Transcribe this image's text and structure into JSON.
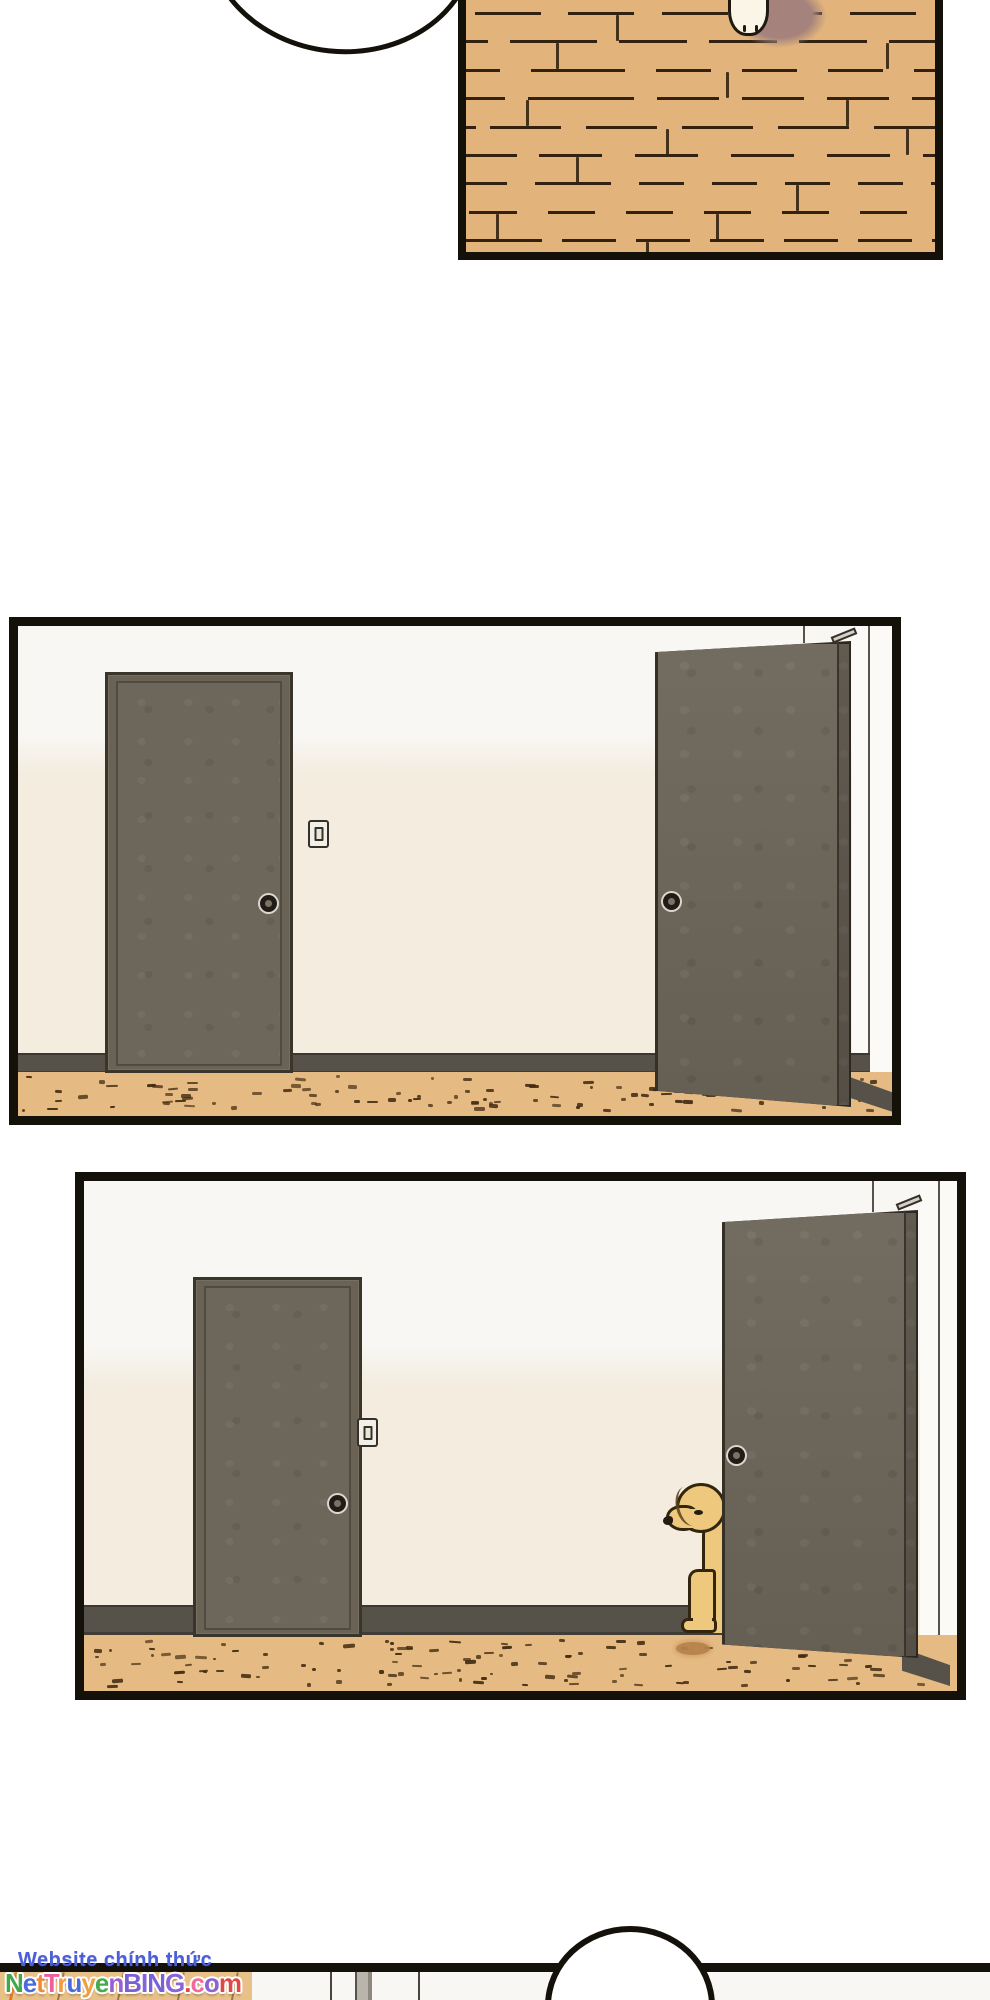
{
  "palette": {
    "ink": "#14110b",
    "wood": "#e2b47c",
    "wood_line": "#33220f",
    "wall_top": "#f8f7f3",
    "wall_low": "#f3ecdf",
    "wall_side": "#fbfaf7",
    "door": "#6d665a",
    "door_outline": "#353026",
    "door_frame": "#6a6355",
    "baseboard": "#56524a",
    "floor": "#e6ba83",
    "speck": "#402a10",
    "dog": "#eec87d",
    "dog_outline": "#33260f",
    "shadow_brown": "#a5837c",
    "paw_white": "#faf5e6",
    "puddle": "#b5814a",
    "bubble_fill": "#ffffff",
    "watermark_blue": "#4a5fd8"
  },
  "watermark": {
    "site_label": "Website chính thức",
    "site_name_letters": [
      {
        "ch": "N",
        "color": "#3fa84a"
      },
      {
        "ch": "e",
        "color": "#4a6bdc"
      },
      {
        "ch": "t",
        "color": "#f08a3a"
      },
      {
        "ch": "T",
        "color": "#ee5f9e"
      },
      {
        "ch": "r",
        "color": "#f49b3c"
      },
      {
        "ch": "u",
        "color": "#4a6bdc"
      },
      {
        "ch": "y",
        "color": "#f0a03f"
      },
      {
        "ch": "e",
        "color": "#46ab4a"
      },
      {
        "ch": "n",
        "color": "#9a5fd4"
      },
      {
        "ch": "B",
        "color": "#7a5fd6"
      },
      {
        "ch": "I",
        "color": "#8765d8"
      },
      {
        "ch": "N",
        "color": "#7a5fd6"
      },
      {
        "ch": "G",
        "color": "#8765d8"
      },
      {
        "ch": ".",
        "color": "#e04848"
      },
      {
        "ch": "c",
        "color": "#ef6a9c"
      },
      {
        "ch": "o",
        "color": "#8a63d4"
      },
      {
        "ch": "m",
        "color": "#e04848"
      }
    ]
  }
}
